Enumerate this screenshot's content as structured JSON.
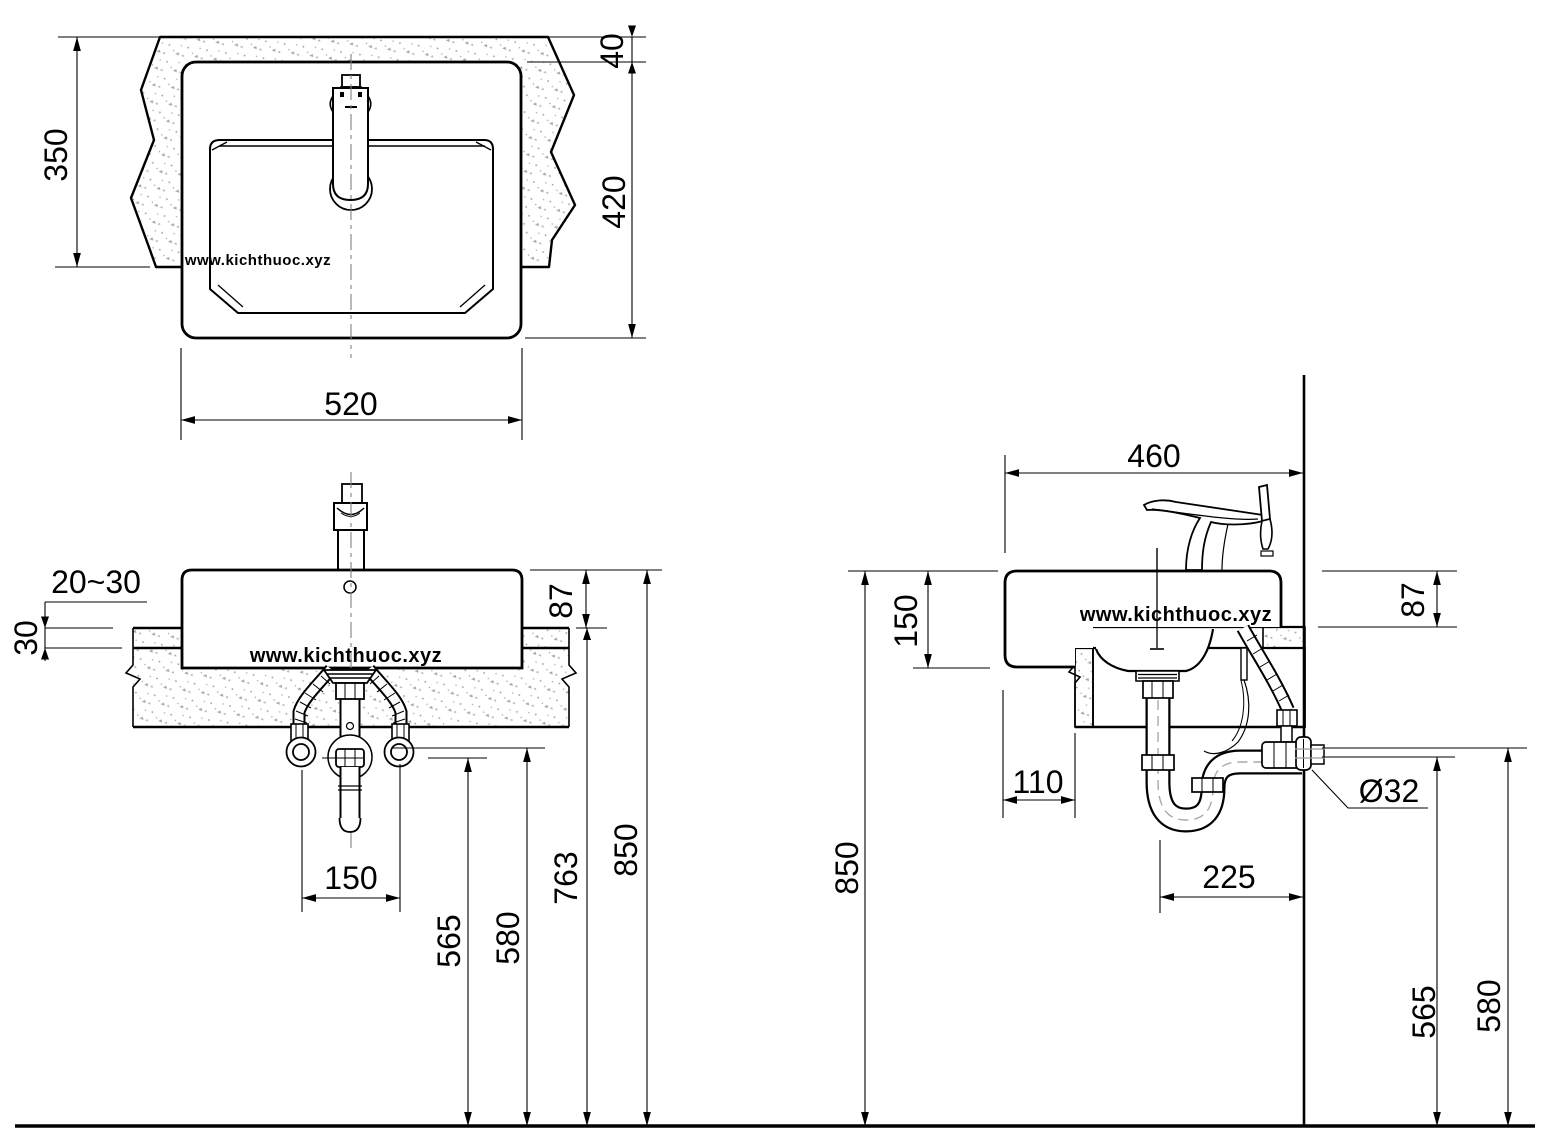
{
  "drawing": {
    "type": "technical-dimension-drawing",
    "subject": "semi-recessed washbasin installation, three orthographic views with plumbing",
    "watermark": "www.kichthuoc.xyz",
    "colors": {
      "line": "#000000",
      "stipple": "#9b9b9b",
      "centerline": "#808080",
      "pipe_center": "#aaaaaa",
      "background": "#ffffff"
    }
  },
  "views": {
    "top_view": {
      "dims": {
        "counter_front_depth": "350",
        "counter_back_strip": "40",
        "basin_depth": "420",
        "basin_width": "520"
      }
    },
    "front_view": {
      "dims": {
        "rim_gap": "20~30",
        "counter_thickness": "30",
        "rim_above_counter": "87",
        "supply_spacing": "150",
        "drain_outlet_height": "565",
        "supply_height": "580",
        "counter_top_height": "763",
        "rim_height": "850"
      }
    },
    "side_view": {
      "dims": {
        "basin_total_depth": "460",
        "basin_body_height": "150",
        "rim_above_counter": "87",
        "front_overhang": "110",
        "trap_to_wall": "225",
        "drain_pipe_diameter": "Ø32",
        "drain_outlet_height": "565",
        "supply_height": "580",
        "rim_height": "850"
      }
    }
  }
}
